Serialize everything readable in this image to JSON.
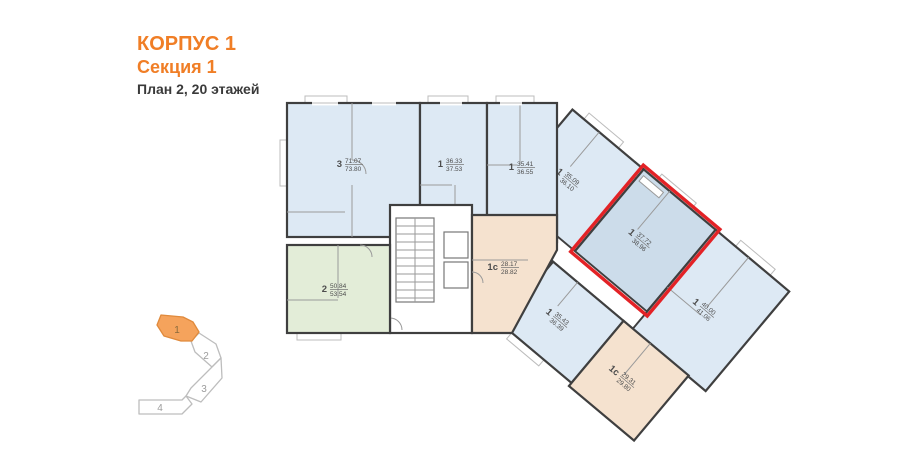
{
  "header": {
    "building": "КОРПУС 1",
    "section": "Секция 1",
    "plan_info": "План 2, 20 этажей"
  },
  "minimap": {
    "active_section": "1",
    "sections": [
      {
        "label": "1",
        "active": true
      },
      {
        "label": "2",
        "active": false
      },
      {
        "label": "3",
        "active": false
      },
      {
        "label": "4",
        "active": false
      }
    ]
  },
  "plan": {
    "apartments": [
      {
        "id": "apt-3room-left",
        "type": "3",
        "area1": "71.07",
        "area2": "73.80",
        "color": "blue"
      },
      {
        "id": "apt-1room-a",
        "type": "1",
        "area1": "36.33",
        "area2": "37.53",
        "color": "blue"
      },
      {
        "id": "apt-1room-b",
        "type": "1",
        "area1": "35.41",
        "area2": "36.55",
        "color": "blue"
      },
      {
        "id": "apt-2room-green",
        "type": "2",
        "area1": "50.84",
        "area2": "53.54",
        "color": "green"
      },
      {
        "id": "apt-1s-core",
        "type": "1с",
        "area1": "28.17",
        "area2": "28.82",
        "color": "peach"
      },
      {
        "id": "apt-1room-diag-top",
        "type": "1",
        "area1": "35.09",
        "area2": "36.10",
        "color": "blue"
      },
      {
        "id": "apt-1room-selected",
        "type": "1",
        "area1": "37.72",
        "area2": "38.96",
        "color": "blue",
        "selected": true
      },
      {
        "id": "apt-1room-end",
        "type": "1",
        "area1": "40.00",
        "area2": "41.06",
        "color": "blue"
      },
      {
        "id": "apt-1s-diag-a",
        "type": "1с",
        "area1": "28.28",
        "area2": "28.93",
        "color": "peach"
      },
      {
        "id": "apt-1room-diag-low",
        "type": "1",
        "area1": "35.43",
        "area2": "36.39",
        "color": "blue"
      },
      {
        "id": "apt-1s-diag-b",
        "type": "1с",
        "area1": "29.31",
        "area2": "29.80",
        "color": "peach"
      }
    ]
  },
  "colors": {
    "accent_orange": "#f07e26",
    "highlight_red": "#e32226",
    "minimap_active_fill": "#f5a35c",
    "fill_blue": "#dde9f4",
    "fill_blue_selected": "#ccdcea",
    "fill_green": "#e3edd8",
    "fill_peach": "#f5e2cf",
    "wall": "#3f3f3f"
  }
}
